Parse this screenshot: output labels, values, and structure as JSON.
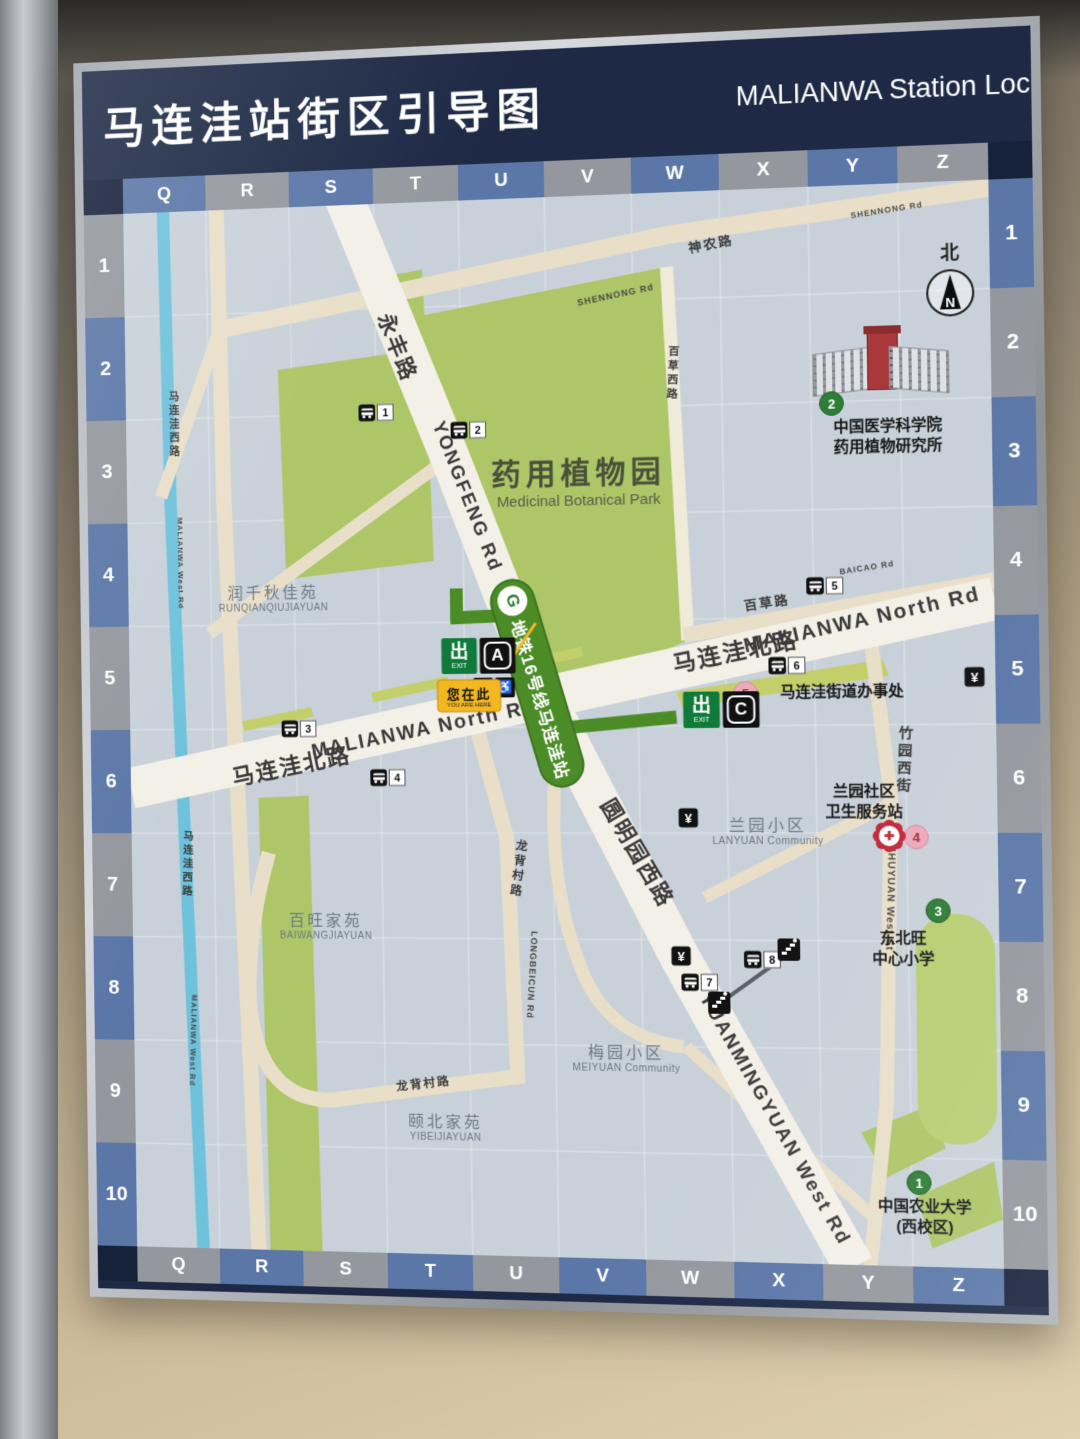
{
  "header": {
    "title_cn": "马连洼站街区引导图",
    "title_en": "MALIANWA Station Loca"
  },
  "grid": {
    "letters": [
      "Q",
      "R",
      "S",
      "T",
      "U",
      "V",
      "W",
      "X",
      "Y",
      "Z"
    ],
    "numbers": [
      "1",
      "2",
      "3",
      "4",
      "5",
      "6",
      "7",
      "8",
      "9",
      "10"
    ]
  },
  "north": {
    "label": "北",
    "letter": "N"
  },
  "station": {
    "line_label": "地铁16号线马连洼站",
    "logo_letter": "G"
  },
  "exit_sign": {
    "cn": "出",
    "en": "EXIT"
  },
  "you_are_here": {
    "cn": "您在此",
    "en": "YOU ARE HERE"
  },
  "park": {
    "cn": "药用植物园",
    "en": "Medicinal Botanical Park"
  },
  "icons": {
    "yen": "¥",
    "wheelchair": "♿",
    "elevator": "▲▼",
    "cross": "✚"
  },
  "map": {
    "road_labels": [
      {
        "t": "永丰路",
        "x": 285,
        "y": 145,
        "rot": 69,
        "s": 22,
        "cls": "cn"
      },
      {
        "t": "YONGFENG Rd",
        "x": 352,
        "y": 298,
        "rot": 69,
        "s": 19,
        "cls": "cn"
      },
      {
        "t": "马连洼北路",
        "x": 168,
        "y": 566,
        "rot": -11,
        "s": 23,
        "cls": "cn"
      },
      {
        "t": "MALIANWA North Rd",
        "x": 305,
        "y": 532,
        "rot": -11,
        "s": 20,
        "cls": "cn"
      },
      {
        "t": "马连洼北路",
        "x": 618,
        "y": 455,
        "rot": -11,
        "s": 23,
        "cls": "cn"
      },
      {
        "t": "MALIANWA North Rd",
        "x": 742,
        "y": 428,
        "rot": -12,
        "s": 20,
        "cls": "cn"
      },
      {
        "t": "圆明园西路",
        "x": 520,
        "y": 655,
        "rot": 60,
        "s": 22,
        "cls": "cn"
      },
      {
        "t": "YUANMINGYUAN West Rd",
        "x": 650,
        "y": 918,
        "rot": 61,
        "s": 19,
        "cls": "cn"
      },
      {
        "t": "神农路",
        "x": 600,
        "y": 52,
        "rot": -9,
        "s": 13,
        "cls": "cn"
      },
      {
        "t": "SHENNONG Rd",
        "x": 505,
        "y": 100,
        "rot": -10,
        "s": 9,
        "cls": "en"
      },
      {
        "t": "SHENNONG Rd",
        "x": 772,
        "y": 26,
        "rot": -7,
        "s": 8,
        "cls": "en"
      },
      {
        "t": "百草路",
        "x": 650,
        "y": 408,
        "rot": -8,
        "s": 13,
        "cls": "cn"
      },
      {
        "t": "BAICAO Rd",
        "x": 748,
        "y": 376,
        "rot": -8,
        "s": 8,
        "cls": "en"
      },
      {
        "t": "百草西路",
        "x": 560,
        "y": 180,
        "rot": 3,
        "s": 11,
        "cls": "cn",
        "v": 1
      },
      {
        "t": "竹园西街",
        "x": 782,
        "y": 565,
        "rot": 3,
        "s": 14,
        "cls": "cn",
        "v": 1
      },
      {
        "t": "ZHUYUAN West St",
        "x": 766,
        "y": 700,
        "rot": 92,
        "s": 10,
        "cls": "en"
      },
      {
        "t": "龙背村路",
        "x": 400,
        "y": 672,
        "rot": 8,
        "s": 12,
        "cls": "cn",
        "v": 1
      },
      {
        "t": "LONGBEICUN Rd",
        "x": 412,
        "y": 778,
        "rot": 94,
        "s": 9,
        "cls": "en"
      },
      {
        "t": "龙背村路",
        "x": 300,
        "y": 888,
        "rot": -7,
        "s": 12,
        "cls": "cn"
      },
      {
        "t": "马连洼西路",
        "x": 50,
        "y": 218,
        "rot": 0,
        "s": 11,
        "cls": "cn",
        "v": 1
      },
      {
        "t": "MALIANWA West Rd",
        "x": 55,
        "y": 360,
        "rot": 90,
        "s": 8,
        "cls": "en"
      },
      {
        "t": "马连洼西路",
        "x": 58,
        "y": 668,
        "rot": 2,
        "s": 11,
        "cls": "cn",
        "v": 1
      },
      {
        "t": "MALIANWA West Rd",
        "x": 62,
        "y": 848,
        "rot": 92,
        "s": 8,
        "cls": "en"
      }
    ],
    "communities": [
      {
        "cn": "润千秋佳苑",
        "en": "RUNQIANQIUJIAYUAN",
        "x": 152,
        "y": 395
      },
      {
        "cn": "百旺家苑",
        "en": "BAIWANGJIAYUAN",
        "x": 202,
        "y": 728
      },
      {
        "cn": "兰园小区",
        "en": "LANYUAN Community",
        "x": 648,
        "y": 632
      },
      {
        "cn": "梅园小区",
        "en": "MEIYUAN Community",
        "x": 505,
        "y": 858
      },
      {
        "cn": "颐北家苑",
        "en": "YIBEIJIAYUAN",
        "x": 322,
        "y": 930
      }
    ],
    "pois": [
      {
        "num": "1",
        "color": "green",
        "cx": 790,
        "cy": 978,
        "tx": 795,
        "ty": 1012,
        "lines": [
          "中国农业大学",
          "(西校区)"
        ]
      },
      {
        "num": "2",
        "color": "green",
        "cx": 716,
        "cy": 214,
        "tx": 770,
        "ty": 248,
        "lines": [
          "中国医学科学院",
          "药用植物研究所"
        ]
      },
      {
        "num": "3",
        "color": "green",
        "cx": 812,
        "cy": 712,
        "tx": 778,
        "ty": 750,
        "lines": [
          "东北旺",
          "中心小学"
        ]
      },
      {
        "num": "4",
        "color": "pink",
        "cx": 792,
        "cy": 640,
        "tx": 742,
        "ty": 606,
        "lines": [
          "兰园社区",
          "卫生服务站"
        ]
      },
      {
        "num": "5",
        "color": "pink",
        "cx": 628,
        "cy": 498,
        "tx": 722,
        "ty": 498,
        "lines": [
          "马连洼街道办事处"
        ]
      }
    ],
    "bus_stops": [
      {
        "n": "1",
        "x": 261,
        "y": 211
      },
      {
        "n": "2",
        "x": 355,
        "y": 231
      },
      {
        "n": "3",
        "x": 177,
        "y": 530
      },
      {
        "n": "4",
        "x": 268,
        "y": 580
      },
      {
        "n": "5",
        "x": 707,
        "y": 393
      },
      {
        "n": "6",
        "x": 669,
        "y": 471
      },
      {
        "n": "7",
        "x": 579,
        "y": 784
      },
      {
        "n": "8",
        "x": 641,
        "y": 761
      }
    ],
    "banks": [
      {
        "x": 426,
        "y": 540
      },
      {
        "x": 850,
        "y": 484
      },
      {
        "x": 570,
        "y": 621
      },
      {
        "x": 561,
        "y": 758
      }
    ],
    "footbridges": [
      {
        "x": 598,
        "y": 804
      },
      {
        "x": 667,
        "y": 751
      }
    ],
    "bridge_line": {
      "x": 602,
      "y": 800,
      "len": 78,
      "rot": -36
    },
    "clinic_icon": {
      "x": 766,
      "y": 639
    },
    "exits": [
      {
        "letter": "A",
        "x": 362,
        "y": 458,
        "facilities": true
      },
      {
        "letter": "C",
        "x": 604,
        "y": 514,
        "facilities": false
      }
    ]
  }
}
